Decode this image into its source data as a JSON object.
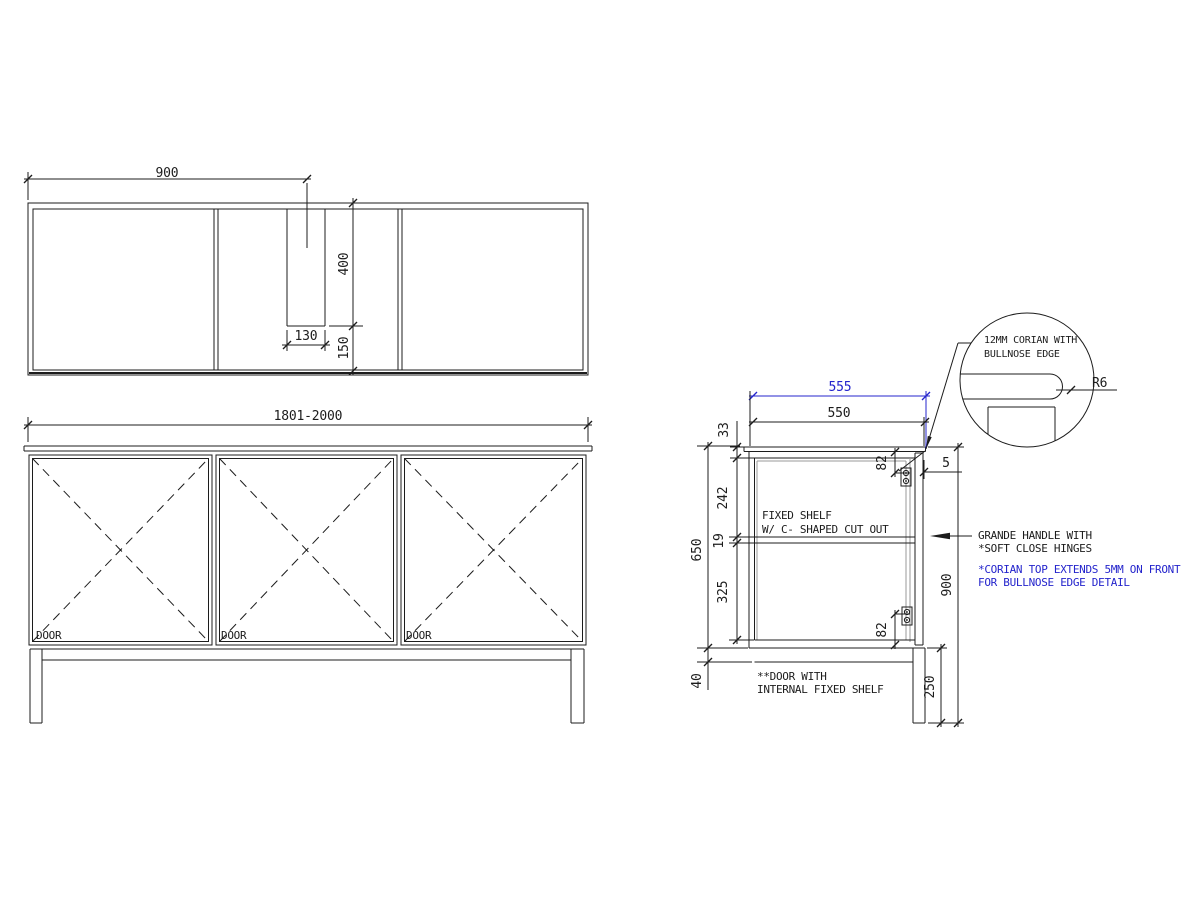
{
  "colors": {
    "line": "#1c1c1c",
    "gray": "#9a9a9a",
    "blue": "#2424cc",
    "background": "#ffffff"
  },
  "plan": {
    "dim_width": "900",
    "dim_depth": "400",
    "dim_slot_width": "130",
    "dim_slot_back": "150"
  },
  "front": {
    "dim_overall": "1801-2000",
    "doors": [
      "DOOR",
      "DOOR",
      "DOOR"
    ]
  },
  "side": {
    "dim_top_overall": "555",
    "dim_top_carcass": "550",
    "dim_top_thickness": "33",
    "dim_upper_section": "242",
    "dim_shelf_thickness": "19",
    "dim_lower_section": "325",
    "dim_carcass_height": "650",
    "dim_rail_height": "40",
    "dim_hinge_top": "82",
    "dim_hinge_bottom": "82",
    "dim_overhang": "5",
    "dim_total_height": "900",
    "dim_leg_height": "250",
    "shelf_note": [
      "FIXED SHELF",
      "W/ C- SHAPED CUT OUT"
    ],
    "handle_note": [
      "GRANDE HANDLE WITH",
      "*SOFT CLOSE HINGES"
    ],
    "corian_note": [
      "*CORIAN TOP EXTENDS 5MM ON FRONT",
      "FOR BULLNOSE EDGE DETAIL"
    ],
    "door_note": [
      "**DOOR WITH",
      "INTERNAL FIXED SHELF"
    ]
  },
  "detail": {
    "note": [
      "12MM CORIAN WITH",
      "BULLNOSE EDGE"
    ],
    "dim_radius": "R6"
  }
}
